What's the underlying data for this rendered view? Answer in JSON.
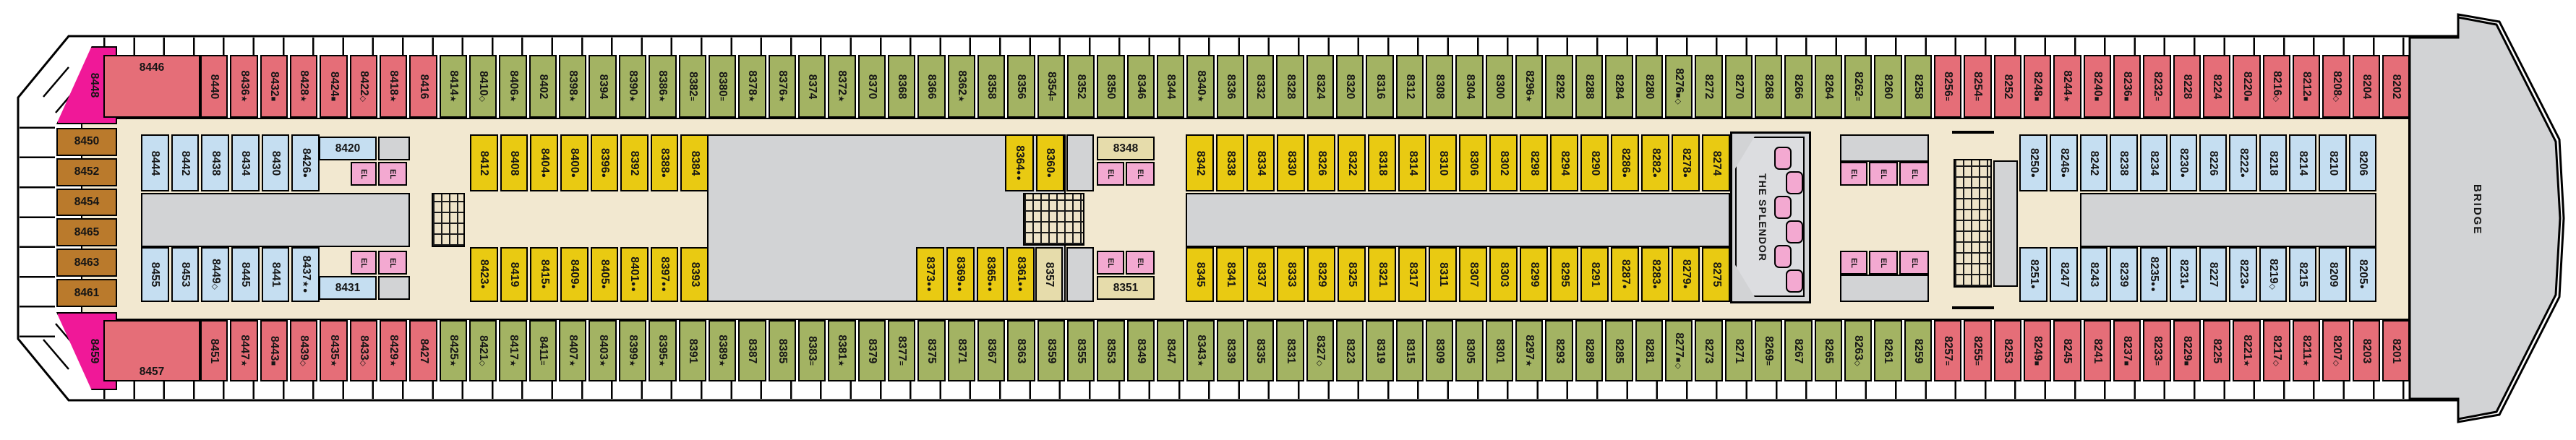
{
  "ship": {
    "suite_label": "THE SPLENDOR",
    "bridge_label": "BRIDGE",
    "el_label": "EL"
  },
  "colors": {
    "balcony_red": "#e56e78",
    "balcony_green": "#a3b363",
    "interior_yellow": "#e9ca12",
    "interior_blue": "#c5def1",
    "room_beige": "#e6dcab",
    "suite_magenta": "#f01898",
    "aft_brown": "#ba7a2c",
    "elevator_pink": "#f3a9d1",
    "corridor_tan": "#f2e8d0",
    "public_gray": "#d2d3d5"
  },
  "cabins": {
    "corner_top": {
      "n": "8448",
      "c": "m",
      "s": ""
    },
    "corner_bottom": {
      "n": "8459",
      "c": "m",
      "s": ""
    },
    "wide_top": {
      "n": "8446",
      "c": "r",
      "s": ""
    },
    "wide_bottom": {
      "n": "8457",
      "c": "r",
      "s": ""
    },
    "room_8420": {
      "n": "8420",
      "c": "b",
      "s": ""
    },
    "room_8431": {
      "n": "8431",
      "c": "b",
      "s": ""
    },
    "room_8348": {
      "n": "8348",
      "c": "t",
      "s": ""
    },
    "room_8351": {
      "n": "8351",
      "c": "t",
      "s": ""
    },
    "room_8357": {
      "n": "8357",
      "c": "t",
      "s": ""
    },
    "aft_column": [
      {
        "n": "8450",
        "c": "br",
        "s": ""
      },
      {
        "n": "8452",
        "c": "br",
        "s": ""
      },
      {
        "n": "8454",
        "c": "br",
        "s": ""
      },
      {
        "n": "8465",
        "c": "br",
        "s": ""
      },
      {
        "n": "8463",
        "c": "br",
        "s": ""
      },
      {
        "n": "8461",
        "c": "br",
        "s": ""
      }
    ],
    "top_run": [
      {
        "n": "8440",
        "c": "r",
        "s": ""
      },
      {
        "n": "8436",
        "c": "r",
        "s": "★"
      },
      {
        "n": "8432",
        "c": "r",
        "s": "■"
      },
      {
        "n": "8428",
        "c": "r",
        "s": "★"
      },
      {
        "n": "8424",
        "c": "r",
        "s": "■"
      },
      {
        "n": "8422",
        "c": "r",
        "s": "◇"
      },
      {
        "n": "8418",
        "c": "r",
        "s": "★"
      },
      {
        "n": "8416",
        "c": "r",
        "s": ""
      },
      {
        "n": "8414",
        "c": "g",
        "s": "★"
      },
      {
        "n": "8410",
        "c": "g",
        "s": "◇"
      },
      {
        "n": "8406",
        "c": "g",
        "s": "★"
      },
      {
        "n": "8402",
        "c": "g",
        "s": ""
      },
      {
        "n": "8398",
        "c": "g",
        "s": "★"
      },
      {
        "n": "8394",
        "c": "g",
        "s": ""
      },
      {
        "n": "8390",
        "c": "g",
        "s": "★"
      },
      {
        "n": "8386",
        "c": "g",
        "s": "★"
      },
      {
        "n": "8382",
        "c": "g",
        "s": "="
      },
      {
        "n": "8380",
        "c": "g",
        "s": "="
      },
      {
        "n": "8378",
        "c": "g",
        "s": "★"
      },
      {
        "n": "8376",
        "c": "g",
        "s": "★"
      },
      {
        "n": "8374",
        "c": "g",
        "s": ""
      },
      {
        "n": "8372",
        "c": "g",
        "s": "★"
      },
      {
        "n": "8370",
        "c": "g",
        "s": ""
      },
      {
        "n": "8368",
        "c": "g",
        "s": ""
      },
      {
        "n": "8366",
        "c": "g",
        "s": ""
      },
      {
        "n": "8362",
        "c": "g",
        "s": "★"
      },
      {
        "n": "8358",
        "c": "g",
        "s": ""
      },
      {
        "n": "8356",
        "c": "g",
        "s": ""
      },
      {
        "n": "8354",
        "c": "g",
        "s": "="
      },
      {
        "n": "8352",
        "c": "g",
        "s": ""
      },
      {
        "n": "8350",
        "c": "g",
        "s": ""
      },
      {
        "n": "8346",
        "c": "g",
        "s": ""
      },
      {
        "n": "8344",
        "c": "g",
        "s": ""
      },
      {
        "n": "8340",
        "c": "g",
        "s": "★"
      },
      {
        "n": "8336",
        "c": "g",
        "s": ""
      },
      {
        "n": "8332",
        "c": "g",
        "s": ""
      },
      {
        "n": "8328",
        "c": "g",
        "s": ""
      },
      {
        "n": "8324",
        "c": "g",
        "s": ""
      },
      {
        "n": "8320",
        "c": "g",
        "s": ""
      },
      {
        "n": "8316",
        "c": "g",
        "s": ""
      },
      {
        "n": "8312",
        "c": "g",
        "s": ""
      },
      {
        "n": "8308",
        "c": "g",
        "s": ""
      },
      {
        "n": "8304",
        "c": "g",
        "s": ""
      },
      {
        "n": "8300",
        "c": "g",
        "s": ""
      },
      {
        "n": "8296",
        "c": "g",
        "s": "★"
      },
      {
        "n": "8292",
        "c": "g",
        "s": ""
      },
      {
        "n": "8288",
        "c": "g",
        "s": ""
      },
      {
        "n": "8284",
        "c": "g",
        "s": ""
      },
      {
        "n": "8280",
        "c": "g",
        "s": ""
      },
      {
        "n": "8276",
        "c": "g",
        "s": "■◇"
      },
      {
        "n": "8272",
        "c": "g",
        "s": ""
      },
      {
        "n": "8270",
        "c": "g",
        "s": ""
      },
      {
        "n": "8268",
        "c": "g",
        "s": ""
      },
      {
        "n": "8266",
        "c": "g",
        "s": ""
      },
      {
        "n": "8264",
        "c": "g",
        "s": ""
      },
      {
        "n": "8262",
        "c": "g",
        "s": "="
      },
      {
        "n": "8260",
        "c": "g",
        "s": ""
      },
      {
        "n": "8258",
        "c": "g",
        "s": ""
      },
      {
        "n": "8256",
        "c": "r",
        "s": "="
      },
      {
        "n": "8254",
        "c": "r",
        "s": "="
      },
      {
        "n": "8252",
        "c": "r",
        "s": ""
      },
      {
        "n": "8248",
        "c": "r",
        "s": "■"
      },
      {
        "n": "8244",
        "c": "r",
        "s": "★"
      },
      {
        "n": "8240",
        "c": "r",
        "s": "■"
      },
      {
        "n": "8236",
        "c": "r",
        "s": "■"
      },
      {
        "n": "8232",
        "c": "r",
        "s": "="
      },
      {
        "n": "8228",
        "c": "r",
        "s": ""
      },
      {
        "n": "8224",
        "c": "r",
        "s": ""
      },
      {
        "n": "8220",
        "c": "r",
        "s": "■"
      },
      {
        "n": "8216",
        "c": "r",
        "s": "◇"
      },
      {
        "n": "8212",
        "c": "r",
        "s": "■"
      },
      {
        "n": "8208",
        "c": "r",
        "s": "◇"
      },
      {
        "n": "8204",
        "c": "r",
        "s": ""
      },
      {
        "n": "8202",
        "c": "r",
        "s": ""
      }
    ],
    "bottom_run": [
      {
        "n": "8451",
        "c": "r",
        "s": ""
      },
      {
        "n": "8447",
        "c": "r",
        "s": "★"
      },
      {
        "n": "8443",
        "c": "r",
        "s": "■"
      },
      {
        "n": "8439",
        "c": "r",
        "s": "◇"
      },
      {
        "n": "8435",
        "c": "r",
        "s": "★"
      },
      {
        "n": "8433",
        "c": "r",
        "s": "◇"
      },
      {
        "n": "8429",
        "c": "r",
        "s": "★"
      },
      {
        "n": "8427",
        "c": "r",
        "s": ""
      },
      {
        "n": "8425",
        "c": "g",
        "s": "★"
      },
      {
        "n": "8421",
        "c": "g",
        "s": "◇"
      },
      {
        "n": "8417",
        "c": "g",
        "s": "★"
      },
      {
        "n": "8411",
        "c": "g",
        "s": "="
      },
      {
        "n": "8407",
        "c": "g",
        "s": "★"
      },
      {
        "n": "8403",
        "c": "g",
        "s": "★"
      },
      {
        "n": "8399",
        "c": "g",
        "s": "★"
      },
      {
        "n": "8395",
        "c": "g",
        "s": "★"
      },
      {
        "n": "8391",
        "c": "g",
        "s": ""
      },
      {
        "n": "8389",
        "c": "g",
        "s": "★"
      },
      {
        "n": "8387",
        "c": "g",
        "s": ""
      },
      {
        "n": "8385",
        "c": "g",
        "s": ""
      },
      {
        "n": "8383",
        "c": "g",
        "s": "="
      },
      {
        "n": "8381",
        "c": "g",
        "s": "★"
      },
      {
        "n": "8379",
        "c": "g",
        "s": ""
      },
      {
        "n": "8377",
        "c": "g",
        "s": "="
      },
      {
        "n": "8375",
        "c": "g",
        "s": ""
      },
      {
        "n": "8371",
        "c": "g",
        "s": ""
      },
      {
        "n": "8367",
        "c": "g",
        "s": ""
      },
      {
        "n": "8363",
        "c": "g",
        "s": ""
      },
      {
        "n": "8359",
        "c": "g",
        "s": ""
      },
      {
        "n": "8355",
        "c": "g",
        "s": ""
      },
      {
        "n": "8353",
        "c": "g",
        "s": ""
      },
      {
        "n": "8349",
        "c": "g",
        "s": ""
      },
      {
        "n": "8347",
        "c": "g",
        "s": ""
      },
      {
        "n": "8343",
        "c": "g",
        "s": "★"
      },
      {
        "n": "8339",
        "c": "g",
        "s": ""
      },
      {
        "n": "8335",
        "c": "g",
        "s": ""
      },
      {
        "n": "8331",
        "c": "g",
        "s": ""
      },
      {
        "n": "8327",
        "c": "g",
        "s": "◇"
      },
      {
        "n": "8323",
        "c": "g",
        "s": ""
      },
      {
        "n": "8319",
        "c": "g",
        "s": ""
      },
      {
        "n": "8315",
        "c": "g",
        "s": ""
      },
      {
        "n": "8309",
        "c": "g",
        "s": ""
      },
      {
        "n": "8305",
        "c": "g",
        "s": ""
      },
      {
        "n": "8301",
        "c": "g",
        "s": ""
      },
      {
        "n": "8297",
        "c": "g",
        "s": "★"
      },
      {
        "n": "8293",
        "c": "g",
        "s": ""
      },
      {
        "n": "8289",
        "c": "g",
        "s": ""
      },
      {
        "n": "8285",
        "c": "g",
        "s": ""
      },
      {
        "n": "8281",
        "c": "g",
        "s": ""
      },
      {
        "n": "8277",
        "c": "g",
        "s": "■◇"
      },
      {
        "n": "8273",
        "c": "g",
        "s": ""
      },
      {
        "n": "8271",
        "c": "g",
        "s": ""
      },
      {
        "n": "8269",
        "c": "g",
        "s": "="
      },
      {
        "n": "8267",
        "c": "g",
        "s": ""
      },
      {
        "n": "8265",
        "c": "g",
        "s": ""
      },
      {
        "n": "8263",
        "c": "g",
        "s": "◇"
      },
      {
        "n": "8261",
        "c": "g",
        "s": ""
      },
      {
        "n": "8259",
        "c": "g",
        "s": ""
      },
      {
        "n": "8257",
        "c": "r",
        "s": "="
      },
      {
        "n": "8255",
        "c": "r",
        "s": "="
      },
      {
        "n": "8253",
        "c": "r",
        "s": ""
      },
      {
        "n": "8249",
        "c": "r",
        "s": "■"
      },
      {
        "n": "8245",
        "c": "r",
        "s": ""
      },
      {
        "n": "8241",
        "c": "r",
        "s": ""
      },
      {
        "n": "8237",
        "c": "r",
        "s": "■"
      },
      {
        "n": "8233",
        "c": "r",
        "s": "="
      },
      {
        "n": "8229",
        "c": "r",
        "s": "■"
      },
      {
        "n": "8225",
        "c": "r",
        "s": ""
      },
      {
        "n": "8221",
        "c": "r",
        "s": "★"
      },
      {
        "n": "8217",
        "c": "r",
        "s": "◇"
      },
      {
        "n": "8211",
        "c": "r",
        "s": "★"
      },
      {
        "n": "8207",
        "c": "r",
        "s": "◇"
      },
      {
        "n": "8203",
        "c": "r",
        "s": ""
      },
      {
        "n": "8201",
        "c": "r",
        "s": ""
      }
    ],
    "int_top_blue_aft": [
      {
        "n": "8444",
        "c": "b",
        "s": ""
      },
      {
        "n": "8442",
        "c": "b",
        "s": ""
      },
      {
        "n": "8438",
        "c": "b",
        "s": ""
      },
      {
        "n": "8434",
        "c": "b",
        "s": ""
      },
      {
        "n": "8430",
        "c": "b",
        "s": ""
      },
      {
        "n": "8426",
        "c": "b",
        "s": "●"
      }
    ],
    "int_bot_blue_aft": [
      {
        "n": "8455",
        "c": "b",
        "s": ""
      },
      {
        "n": "8453",
        "c": "b",
        "s": ""
      },
      {
        "n": "8449",
        "c": "b",
        "s": "◇"
      },
      {
        "n": "8445",
        "c": "b",
        "s": ""
      },
      {
        "n": "8441",
        "c": "b",
        "s": ""
      },
      {
        "n": "8437",
        "c": "b",
        "s": "★●"
      }
    ],
    "int_top_yellow_aft": [
      {
        "n": "8412",
        "c": "y",
        "s": ""
      },
      {
        "n": "8408",
        "c": "y",
        "s": ""
      },
      {
        "n": "8404",
        "c": "y",
        "s": "●"
      },
      {
        "n": "8400",
        "c": "y",
        "s": "●"
      },
      {
        "n": "8396",
        "c": "y",
        "s": "●"
      },
      {
        "n": "8392",
        "c": "y",
        "s": ""
      },
      {
        "n": "8388",
        "c": "y",
        "s": "●"
      },
      {
        "n": "8384",
        "c": "y",
        "s": ""
      }
    ],
    "int_bot_yellow_aft": [
      {
        "n": "8423",
        "c": "y",
        "s": "●"
      },
      {
        "n": "8419",
        "c": "y",
        "s": ""
      },
      {
        "n": "8415",
        "c": "y",
        "s": "●"
      },
      {
        "n": "8409",
        "c": "y",
        "s": "●"
      },
      {
        "n": "8405",
        "c": "y",
        "s": "●"
      },
      {
        "n": "8401",
        "c": "y",
        "s": "●●"
      },
      {
        "n": "8397",
        "c": "y",
        "s": "●●"
      },
      {
        "n": "8393",
        "c": "y",
        "s": ""
      }
    ],
    "int_top_yellow_mid": [
      {
        "n": "8364",
        "c": "y",
        "s": "●●"
      },
      {
        "n": "8360",
        "c": "y",
        "s": "●"
      }
    ],
    "int_bot_yellow_mid": [
      {
        "n": "8373",
        "c": "y",
        "s": "●●"
      },
      {
        "n": "8369",
        "c": "y",
        "s": "●●"
      },
      {
        "n": "8365",
        "c": "y",
        "s": "●●"
      },
      {
        "n": "8361",
        "c": "y",
        "s": "●●"
      }
    ],
    "int_top_yellow_fwd": [
      {
        "n": "8342",
        "c": "y",
        "s": ""
      },
      {
        "n": "8338",
        "c": "y",
        "s": ""
      },
      {
        "n": "8334",
        "c": "y",
        "s": ""
      },
      {
        "n": "8330",
        "c": "y",
        "s": ""
      },
      {
        "n": "8326",
        "c": "y",
        "s": ""
      },
      {
        "n": "8322",
        "c": "y",
        "s": ""
      },
      {
        "n": "8318",
        "c": "y",
        "s": ""
      },
      {
        "n": "8314",
        "c": "y",
        "s": ""
      },
      {
        "n": "8310",
        "c": "y",
        "s": ""
      },
      {
        "n": "8306",
        "c": "y",
        "s": ""
      },
      {
        "n": "8302",
        "c": "y",
        "s": ""
      },
      {
        "n": "8298",
        "c": "y",
        "s": ""
      },
      {
        "n": "8294",
        "c": "y",
        "s": ""
      },
      {
        "n": "8290",
        "c": "y",
        "s": ""
      },
      {
        "n": "8286",
        "c": "y",
        "s": "●"
      },
      {
        "n": "8282",
        "c": "y",
        "s": "●"
      },
      {
        "n": "8278",
        "c": "y",
        "s": "●"
      },
      {
        "n": "8274",
        "c": "y",
        "s": ""
      }
    ],
    "int_bot_yellow_fwd": [
      {
        "n": "8345",
        "c": "y",
        "s": ""
      },
      {
        "n": "8341",
        "c": "y",
        "s": ""
      },
      {
        "n": "8337",
        "c": "y",
        "s": ""
      },
      {
        "n": "8333",
        "c": "y",
        "s": ""
      },
      {
        "n": "8329",
        "c": "y",
        "s": ""
      },
      {
        "n": "8325",
        "c": "y",
        "s": ""
      },
      {
        "n": "8321",
        "c": "y",
        "s": ""
      },
      {
        "n": "8317",
        "c": "y",
        "s": ""
      },
      {
        "n": "8311",
        "c": "y",
        "s": ""
      },
      {
        "n": "8307",
        "c": "y",
        "s": ""
      },
      {
        "n": "8303",
        "c": "y",
        "s": ""
      },
      {
        "n": "8299",
        "c": "y",
        "s": ""
      },
      {
        "n": "8295",
        "c": "y",
        "s": ""
      },
      {
        "n": "8291",
        "c": "y",
        "s": ""
      },
      {
        "n": "8287",
        "c": "y",
        "s": "●"
      },
      {
        "n": "8283",
        "c": "y",
        "s": "●"
      },
      {
        "n": "8279",
        "c": "y",
        "s": "●"
      },
      {
        "n": "8275",
        "c": "y",
        "s": ""
      }
    ],
    "int_top_blue_pair": [
      {
        "n": "8250",
        "c": "b",
        "s": "●"
      },
      {
        "n": "8246",
        "c": "b",
        "s": "●"
      }
    ],
    "int_bot_blue_pair": [
      {
        "n": "8251",
        "c": "b",
        "s": "●"
      },
      {
        "n": "8247",
        "c": "b",
        "s": ""
      }
    ],
    "int_top_blue_fwd": [
      {
        "n": "8242",
        "c": "b",
        "s": ""
      },
      {
        "n": "8238",
        "c": "b",
        "s": ""
      },
      {
        "n": "8234",
        "c": "b",
        "s": ""
      },
      {
        "n": "8230",
        "c": "b",
        "s": "●"
      },
      {
        "n": "8226",
        "c": "b",
        "s": ""
      },
      {
        "n": "8222",
        "c": "b",
        "s": "●"
      },
      {
        "n": "8218",
        "c": "b",
        "s": ""
      },
      {
        "n": "8214",
        "c": "b",
        "s": ""
      },
      {
        "n": "8210",
        "c": "b",
        "s": ""
      },
      {
        "n": "8206",
        "c": "b",
        "s": ""
      }
    ],
    "int_bot_blue_fwd": [
      {
        "n": "8243",
        "c": "b",
        "s": ""
      },
      {
        "n": "8239",
        "c": "b",
        "s": ""
      },
      {
        "n": "8235",
        "c": "b",
        "s": "●●"
      },
      {
        "n": "8231",
        "c": "b",
        "s": "●"
      },
      {
        "n": "8227",
        "c": "b",
        "s": ""
      },
      {
        "n": "8223",
        "c": "b",
        "s": "●"
      },
      {
        "n": "8219",
        "c": "b",
        "s": "◇"
      },
      {
        "n": "8215",
        "c": "b",
        "s": ""
      },
      {
        "n": "8209",
        "c": "b",
        "s": ""
      },
      {
        "n": "8205",
        "c": "b",
        "s": "●"
      }
    ]
  }
}
